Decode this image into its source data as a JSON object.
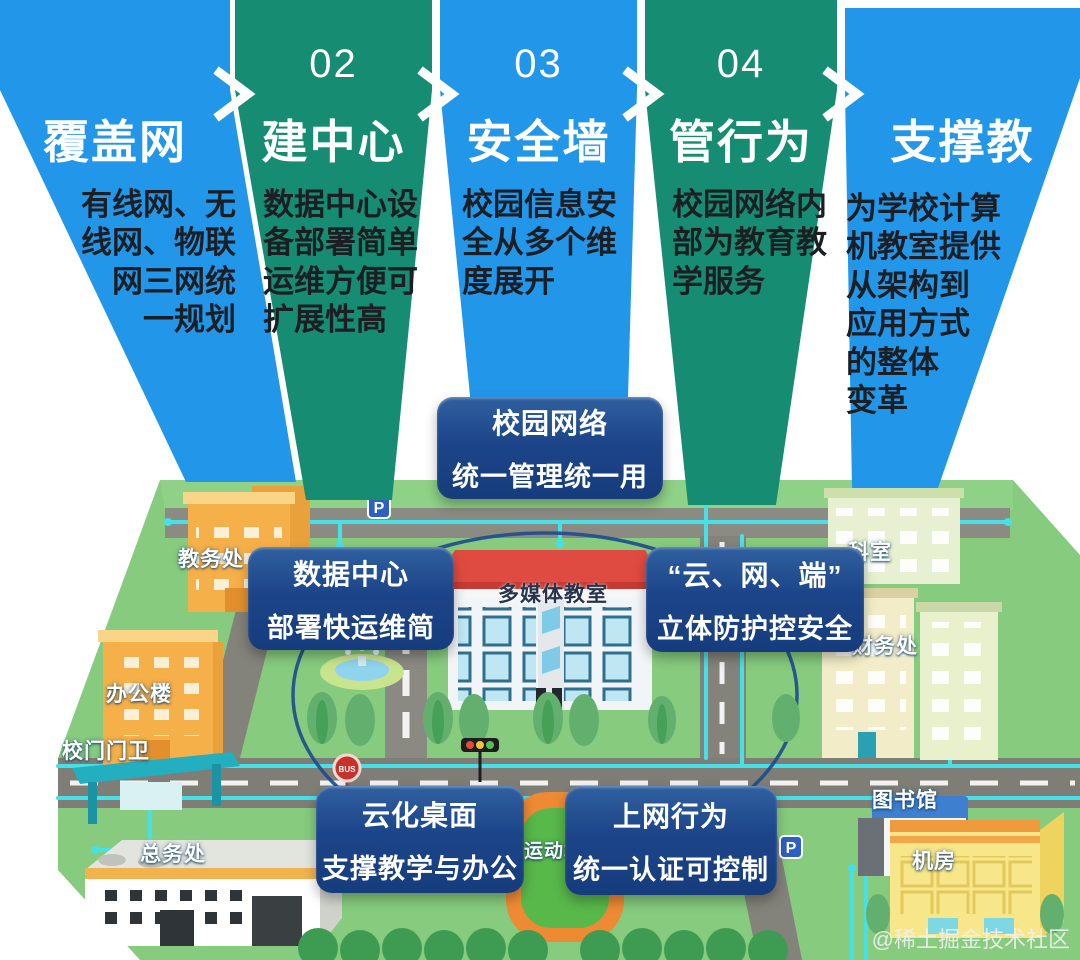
{
  "steps": [
    {
      "number": "",
      "title": "覆盖网",
      "desc": "有线网、无\n线网、物联\n网三网统\n一规划"
    },
    {
      "number": "02",
      "title": "建中心",
      "desc": "数据中心设\n备部署简单\n运维方便可\n扩展性高"
    },
    {
      "number": "03",
      "title": "安全墙",
      "desc": "校园信息安\n全从多个维\n度展开"
    },
    {
      "number": "04",
      "title": "管行为",
      "desc": "校园网络内\n部为教育教\n学服务"
    },
    {
      "number": "",
      "title": "支撑教",
      "desc": "为学校计算\n机教室提供\n从架构到\n应用方式\n的整体\n变革"
    }
  ],
  "callouts": {
    "center_top": {
      "line1": "校园网络",
      "line2": "统一管理统一用"
    },
    "data_center": {
      "line1": "数据中心",
      "line2": "部署快运维简"
    },
    "cloud_net_end": {
      "line1": "“云、网、端”",
      "line2": "立体防护控安全"
    },
    "cloud_desktop": {
      "line1": "云化桌面",
      "line2": "支撑教学与办公"
    },
    "net_behavior": {
      "line1": "上网行为",
      "line2": "统一认证可控制"
    }
  },
  "map": {
    "labels": {
      "jiaowuchu": "教务处",
      "bangonglou": "办公楼",
      "xiaomen_menwei": "校门门卫",
      "zongwuchu": "总务处",
      "duomeiti_jiaoshi": "多媒体教室",
      "yundongchang": "运动场",
      "keshi": "科室",
      "caiwuchu": "财务处",
      "tushuguan": "图书馆",
      "jifang": "机房"
    },
    "icons": {
      "bus_label": "BUS",
      "parking_label": "P"
    }
  },
  "watermark": "@稀土掘金技术社区",
  "colors": {
    "step_blue": "#2296E8",
    "step_teal": "#168C73",
    "callout_navy": "#1B4489",
    "grass_green": "#86CB7E",
    "road_gray": "#7E7E76",
    "network_cyan": "#45E1E7",
    "desc_text": "#1B1F24"
  }
}
